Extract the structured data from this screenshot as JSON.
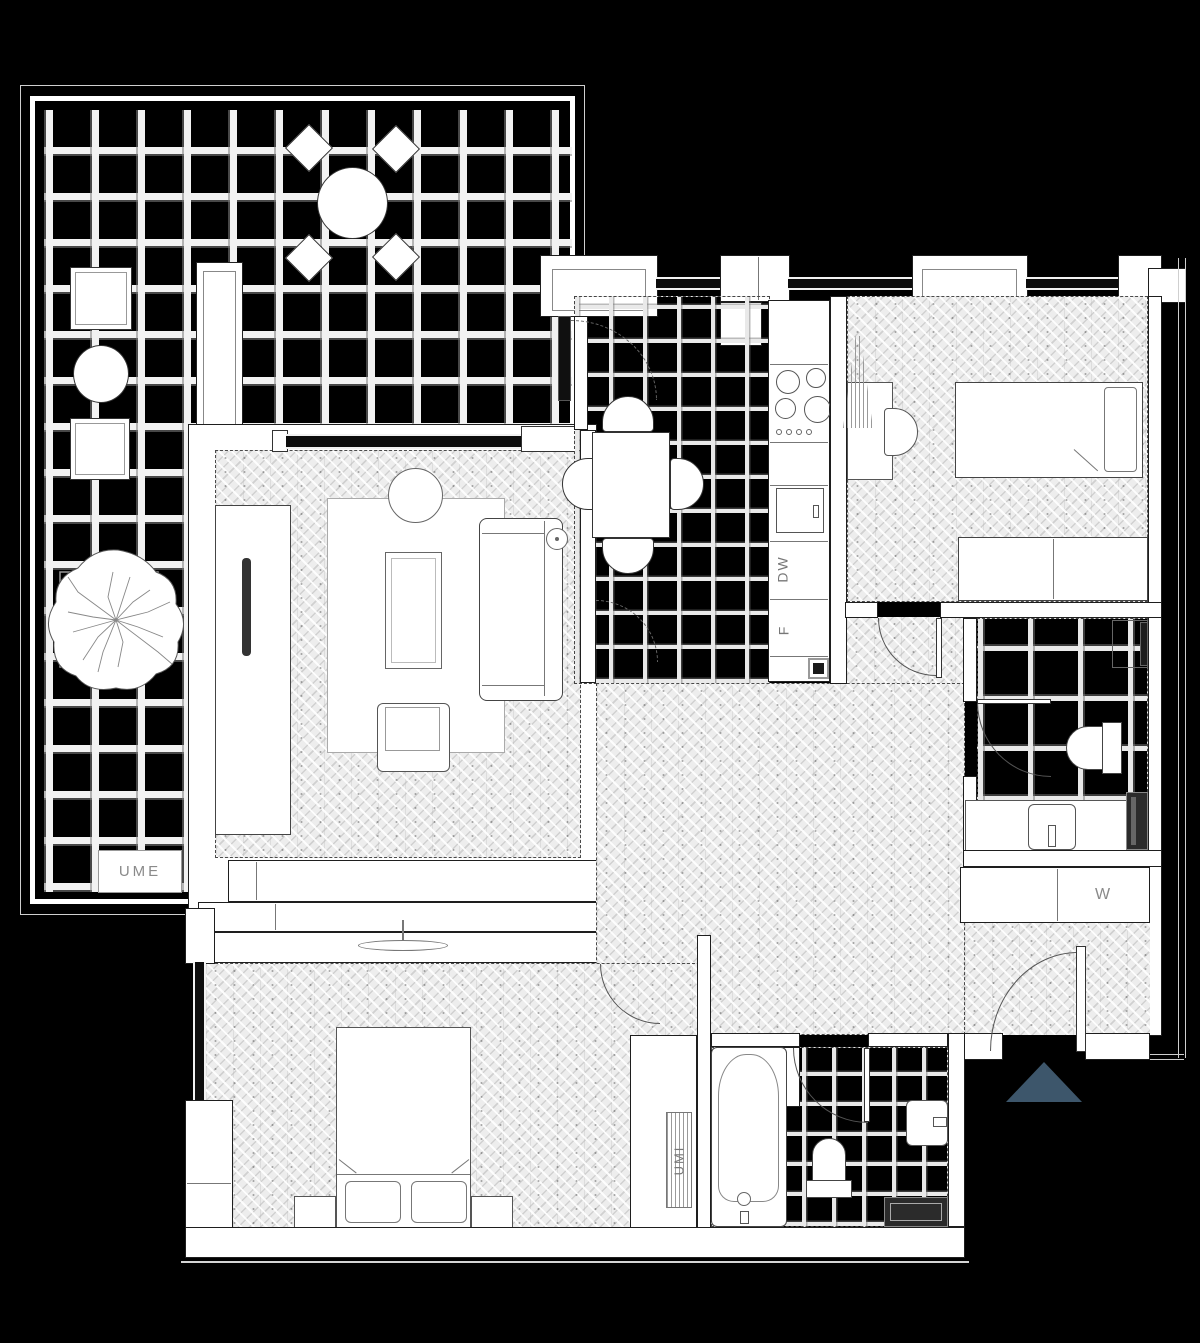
{
  "title": "apartment-floor-plan",
  "labels": {
    "ume": "UME",
    "umi": "UMI",
    "washer": "W",
    "dishwasher": "DW",
    "fridge": "F"
  },
  "colors": {
    "background": "#000000",
    "walls": "#ffffff",
    "linework": "#2a2a2a",
    "wood_floor": "#ededed",
    "label_text": "#8a8a8a",
    "entrance_marker": "#3d566b"
  },
  "markers": {
    "entrance": "entrance-direction-triangle"
  }
}
